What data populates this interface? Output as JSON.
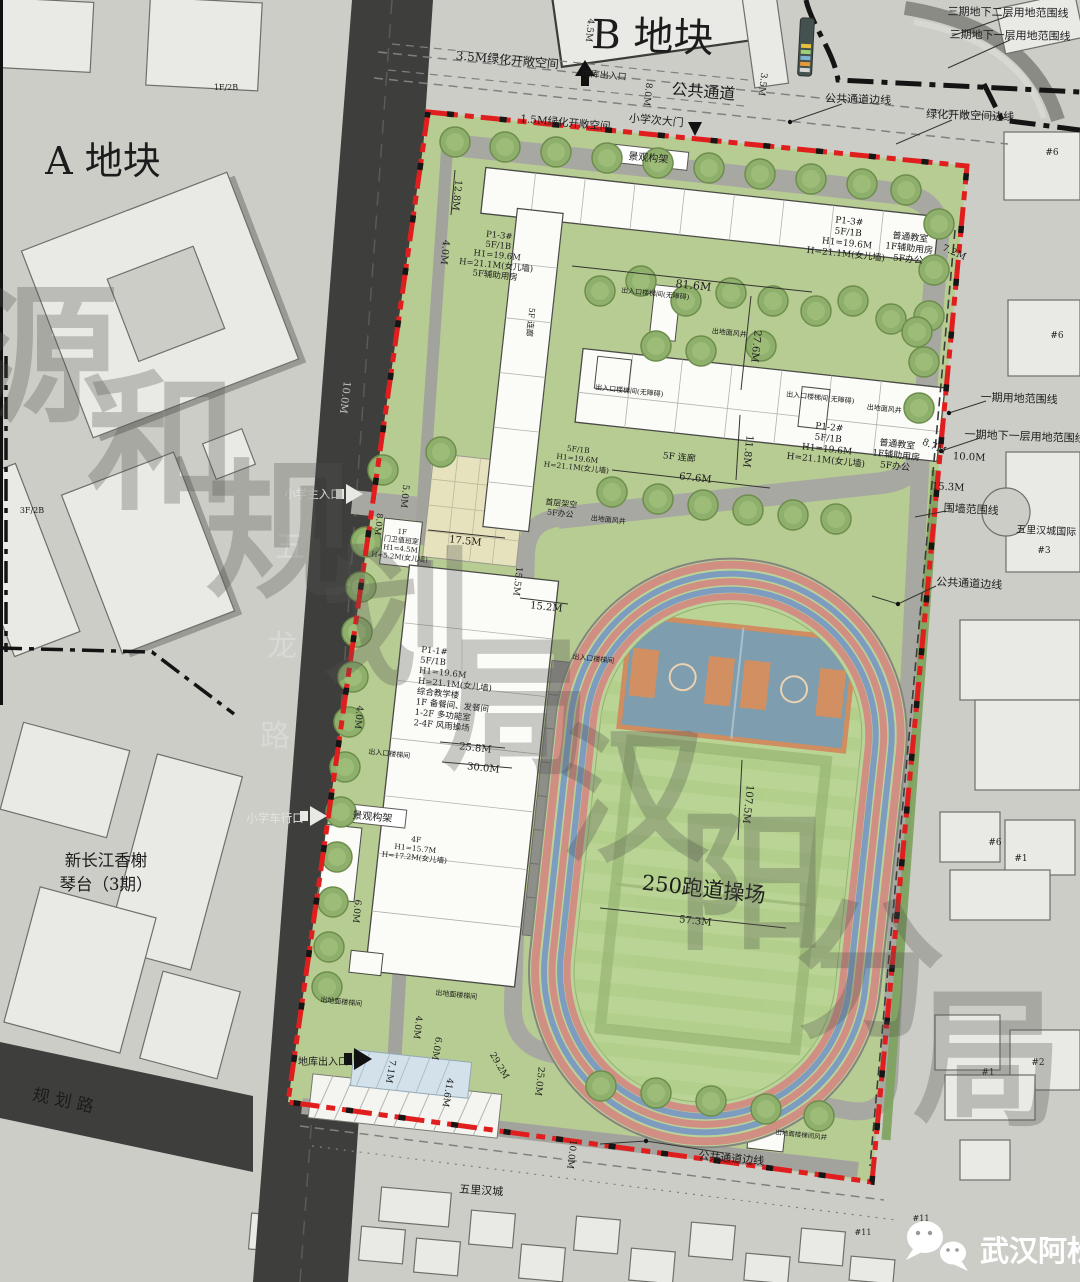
{
  "badge": {
    "text": "武汉阿松"
  },
  "colors": {
    "site_boundary_red": "#e01e1e",
    "phase_boundary_black": "#141414",
    "road_dark": "#3e3e3d",
    "site_green": "#b7cc92",
    "track_red": "#d18f84",
    "track_blue": "#7e9cc0"
  },
  "annotations": [
    {
      "n": "plot-b-label",
      "t": "B 地块",
      "x": 652,
      "y": 50,
      "s": 40,
      "r": 2
    },
    {
      "n": "plot-a-label",
      "t": "A 地块",
      "x": 103,
      "y": 174,
      "s": 38
    },
    {
      "n": "label-phase3-basement2",
      "t": "三期地下二层用地范围线",
      "x": 1008,
      "y": 16,
      "s": 11,
      "r": 1
    },
    {
      "n": "label-phase3-basement1",
      "t": "三期地下一层用地范围线",
      "x": 1010,
      "y": 39,
      "s": 11,
      "r": 1
    },
    {
      "n": "label-green-open-3-5m",
      "t": "3.5M绿化开敞空间",
      "x": 507,
      "y": 64,
      "s": 12,
      "r": 5
    },
    {
      "n": "label-public-passage",
      "t": "公共通道",
      "x": 703,
      "y": 97,
      "s": 16,
      "r": 5
    },
    {
      "n": "label-school-side-gate",
      "t": "小学次大门",
      "x": 656,
      "y": 124,
      "s": 11,
      "r": 5
    },
    {
      "n": "label-b-garage-entry",
      "t": "地库出入口",
      "x": 604,
      "y": 78,
      "s": 9,
      "r": 5
    },
    {
      "n": "label-passage-edge-top",
      "t": "公共通道边线",
      "x": 858,
      "y": 103,
      "s": 11,
      "r": 2
    },
    {
      "n": "label-green-open-edge",
      "t": "绿化开敞空间边线",
      "x": 970,
      "y": 119,
      "s": 11,
      "r": 2
    },
    {
      "n": "label-green-open-1-5m",
      "t": "1.5M绿化开敞空间",
      "x": 565,
      "y": 126,
      "s": 10.5,
      "r": 5
    },
    {
      "n": "label-pergola-top",
      "t": "景观构架",
      "x": 648,
      "y": 161,
      "s": 10,
      "r": 5
    },
    {
      "n": "label-pergola-west",
      "t": "景观构架",
      "x": 372,
      "y": 820,
      "s": 10,
      "r": 5
    },
    {
      "n": "label-main-entrance",
      "t": "小学主入口",
      "x": 313,
      "y": 498,
      "s": 11.5,
      "f": "#e3e3df"
    },
    {
      "n": "label-vehicle-entrance",
      "t": "小学车行口",
      "x": 275,
      "y": 822,
      "s": 11.5,
      "f": "#e3e3df"
    },
    {
      "n": "label-garage-entrance",
      "t": "地库出入口",
      "x": 323,
      "y": 1065,
      "s": 10
    },
    {
      "n": "road-guihua-label",
      "t": "规 划 路",
      "x": 62,
      "y": 1106,
      "s": 17,
      "r": 12
    },
    {
      "n": "road-wulong-char",
      "t": "五",
      "x": 290,
      "y": 557,
      "s": 30,
      "f": "#d8d8d4"
    },
    {
      "n": "road-wulong-char",
      "t": "龙",
      "x": 282,
      "y": 656,
      "s": 30,
      "f": "#d8d8d4"
    },
    {
      "n": "road-wulong-char",
      "t": "路",
      "x": 275,
      "y": 746,
      "s": 30,
      "f": "#d8d8d4"
    },
    {
      "n": "label-xinchangjiang",
      "l": [
        "新长江香榭",
        "琴台（3期）"
      ],
      "x": 106,
      "y": 866,
      "s": 16.5,
      "h": 24
    },
    {
      "n": "building-p1-3-label",
      "l": [
        "P1-3#",
        "5F/1B",
        "H1=19.6M",
        "H=21.1M(女儿墙)"
      ],
      "x": 849,
      "y": 224,
      "s": 9,
      "r": 6,
      "h": 11
    },
    {
      "n": "building-p1-3-use",
      "l": [
        "普通教室",
        "1F辅助用房",
        "5F办公"
      ],
      "x": 910,
      "y": 240,
      "s": 9,
      "r": 6,
      "h": 11
    },
    {
      "n": "building-a-west-label",
      "l": [
        "P1-3#",
        "5F/1B",
        "H1=19.6M",
        "H=21.1M(女儿墙)",
        "5F辅助用房"
      ],
      "x": 499,
      "y": 238,
      "s": 8.5,
      "r": 6,
      "h": 10
    },
    {
      "n": "building-p1-2-label",
      "l": [
        "P1-2#",
        "5F/1B",
        "H1=19.6M",
        "H=21.1M(女儿墙)"
      ],
      "x": 829,
      "y": 430,
      "s": 9,
      "r": 6,
      "h": 11
    },
    {
      "n": "building-p1-2-use",
      "l": [
        "普通教室",
        "1F辅助用房",
        "5F办公"
      ],
      "x": 897,
      "y": 447,
      "s": 9,
      "r": 6,
      "h": 11
    },
    {
      "n": "corridor-b-label",
      "l": [
        "5F/1B",
        "H1=19.6M",
        "H=21.1M(女儿墙)"
      ],
      "x": 578,
      "y": 452,
      "s": 7.5,
      "r": 6,
      "h": 9
    },
    {
      "n": "label-ground-floor-open",
      "l": [
        "首层架空",
        "5F办公"
      ],
      "x": 561,
      "y": 506,
      "s": 8,
      "r": 6,
      "h": 10
    },
    {
      "n": "label-corridor-5f-h",
      "t": "5F 连廊",
      "x": 679,
      "y": 460,
      "s": 9,
      "r": 6
    },
    {
      "n": "label-corridor-5f-v",
      "t": "5F 连廊",
      "x": 528,
      "y": 322,
      "s": 8,
      "r": 96
    },
    {
      "n": "building-p1-1-label",
      "l": [
        "P1-1#",
        "5F/1B",
        "H1=19.6M",
        "H=21.1M(女儿墙)",
        "综合教学楼",
        "1F 备餐间、发餐间",
        "1-2F 多功能室",
        "2-4F 风雨操场"
      ],
      "x": 421,
      "y": 652,
      "s": 8.5,
      "r": 6,
      "h": 10.5,
      "a": "start"
    },
    {
      "n": "guard-house-label",
      "l": [
        "1F",
        "门卫值班室",
        "H1=4.5M",
        "H=5.2M(女儿墙)"
      ],
      "x": 402,
      "y": 534,
      "s": 7,
      "r": 6,
      "h": 8.5
    },
    {
      "n": "building-4f-label",
      "l": [
        "4F",
        "H1=15.7M",
        "H=17.2M(女儿墙)"
      ],
      "x": 416,
      "y": 842,
      "s": 7.5,
      "r": 6,
      "h": 9
    },
    {
      "n": "track-label",
      "t": "250跑道操场",
      "x": 703,
      "y": 896,
      "s": 21,
      "r": 6
    },
    {
      "n": "dim-label",
      "t": "4.5M",
      "x": 587,
      "y": 30,
      "r": 96,
      "s": 9
    },
    {
      "n": "dim-label",
      "t": "8.0M",
      "x": 645,
      "y": 94,
      "r": 97,
      "s": 9
    },
    {
      "n": "dim-label",
      "t": "3.5M",
      "x": 760,
      "y": 84,
      "r": 97,
      "s": 9
    },
    {
      "n": "dim-label",
      "t": "12.8M",
      "x": 454,
      "y": 195,
      "r": 96,
      "s": 9.5
    },
    {
      "n": "dim-label",
      "t": "4.0M",
      "x": 442,
      "y": 252,
      "r": 96,
      "s": 9.5
    },
    {
      "n": "dim-label",
      "t": "81.6M",
      "x": 693,
      "y": 289,
      "r": 6,
      "s": 11
    },
    {
      "n": "dim-label",
      "t": "27.6M",
      "x": 753,
      "y": 346,
      "r": 96,
      "s": 10
    },
    {
      "n": "dim-label",
      "t": "11.8M",
      "x": 745,
      "y": 451,
      "r": 96,
      "s": 10
    },
    {
      "n": "dim-label",
      "t": "67.6M",
      "x": 695,
      "y": 481,
      "r": 6,
      "s": 10
    },
    {
      "n": "dim-label",
      "t": "7.2M",
      "x": 953,
      "y": 255,
      "r": 24,
      "s": 9.5
    },
    {
      "n": "dim-label",
      "t": "8.7M",
      "x": 933,
      "y": 449,
      "r": 24,
      "s": 9.5
    },
    {
      "n": "dim-label",
      "t": "10.0M",
      "x": 969,
      "y": 460,
      "r": 3,
      "s": 10
    },
    {
      "n": "dim-label",
      "t": "15.3M",
      "x": 948,
      "y": 490,
      "r": 3,
      "s": 10
    },
    {
      "n": "dim-label",
      "t": "10.0M",
      "x": 342,
      "y": 397,
      "r": 97,
      "s": 10,
      "f": "#c6c6c2"
    },
    {
      "n": "dim-label",
      "t": "5.0M",
      "x": 402,
      "y": 496,
      "r": 96,
      "s": 9
    },
    {
      "n": "dim-label",
      "t": "8.0M",
      "x": 376,
      "y": 524,
      "r": 96,
      "s": 8.5
    },
    {
      "n": "dim-label",
      "t": "17.5M",
      "x": 465,
      "y": 544,
      "r": 6,
      "s": 10
    },
    {
      "n": "dim-label",
      "t": "15.5M",
      "x": 515,
      "y": 581,
      "r": 96,
      "s": 9
    },
    {
      "n": "dim-label",
      "t": "15.2M",
      "x": 546,
      "y": 610,
      "r": 6,
      "s": 10
    },
    {
      "n": "dim-label",
      "t": "4.0M",
      "x": 356,
      "y": 717,
      "r": 96,
      "s": 9
    },
    {
      "n": "dim-label",
      "t": "25.8M",
      "x": 475,
      "y": 751,
      "r": 6,
      "s": 10
    },
    {
      "n": "dim-label",
      "t": "30.0M",
      "x": 483,
      "y": 771,
      "r": 6,
      "s": 10
    },
    {
      "n": "dim-label",
      "t": "6.0M",
      "x": 354,
      "y": 911,
      "r": 96,
      "s": 9
    },
    {
      "n": "dim-label",
      "t": "4.0M",
      "x": 415,
      "y": 1027,
      "r": 97,
      "s": 9
    },
    {
      "n": "dim-label",
      "t": "6.0M",
      "x": 434,
      "y": 1048,
      "r": 100,
      "s": 9
    },
    {
      "n": "dim-label",
      "t": "7.1M",
      "x": 388,
      "y": 1071,
      "r": 100,
      "s": 9
    },
    {
      "n": "dim-label",
      "t": "41.6M",
      "x": 445,
      "y": 1092,
      "r": 100,
      "s": 9
    },
    {
      "n": "dim-label",
      "t": "29.2M",
      "x": 497,
      "y": 1067,
      "r": 60,
      "s": 9
    },
    {
      "n": "dim-label",
      "t": "25.0M",
      "x": 537,
      "y": 1081,
      "r": 97,
      "s": 9
    },
    {
      "n": "dim-label",
      "t": "57.3M",
      "x": 695,
      "y": 924,
      "r": 6,
      "s": 10
    },
    {
      "n": "dim-label",
      "t": "107.5M",
      "x": 745,
      "y": 804,
      "r": 96,
      "s": 10
    },
    {
      "n": "dim-label",
      "t": "10.0M",
      "x": 569,
      "y": 1154,
      "r": 97,
      "s": 9
    },
    {
      "n": "utility-label",
      "t": "出入口楼梯间(无障碍)",
      "x": 655,
      "y": 296,
      "s": 7,
      "r": 6
    },
    {
      "n": "utility-label",
      "t": "出入口楼梯间(无障碍)",
      "x": 629,
      "y": 393,
      "s": 7,
      "r": 6
    },
    {
      "n": "utility-label",
      "t": "出入口楼梯间(无障碍)",
      "x": 820,
      "y": 400,
      "s": 7,
      "r": 6
    },
    {
      "n": "utility-label",
      "t": "出地面风井",
      "x": 729,
      "y": 335,
      "s": 7,
      "r": 6
    },
    {
      "n": "utility-label",
      "t": "出地面风井",
      "x": 884,
      "y": 411,
      "s": 7,
      "r": 6
    },
    {
      "n": "utility-label",
      "t": "出地面风井",
      "x": 608,
      "y": 522,
      "s": 7,
      "r": 6
    },
    {
      "n": "utility-label",
      "t": "出入口楼梯间",
      "x": 593,
      "y": 661,
      "s": 7,
      "r": 6
    },
    {
      "n": "utility-label",
      "t": "出入口楼梯间",
      "x": 389,
      "y": 756,
      "s": 7,
      "r": 6
    },
    {
      "n": "utility-label",
      "t": "出地面楼梯间",
      "x": 341,
      "y": 1004,
      "s": 7,
      "r": 6
    },
    {
      "n": "utility-label",
      "t": "出地面楼梯间",
      "x": 456,
      "y": 997,
      "s": 7,
      "r": 6
    },
    {
      "n": "utility-label",
      "t": "出地面楼梯间风井",
      "x": 801,
      "y": 1137,
      "s": 6.5,
      "r": 6
    },
    {
      "n": "label-phase1-boundary",
      "t": "一期用地范围线",
      "x": 1019,
      "y": 402,
      "s": 11,
      "r": 2
    },
    {
      "n": "label-phase1-basement1",
      "t": "一期地下一层用地范围线",
      "x": 1025,
      "y": 440,
      "s": 11,
      "r": 2
    },
    {
      "n": "label-wall-boundary",
      "t": "围墙范围线",
      "x": 971,
      "y": 513,
      "s": 11,
      "r": 3
    },
    {
      "n": "label-wulihancheng-intl",
      "t": "五里汉城国际",
      "x": 1046,
      "y": 534,
      "s": 10,
      "r": 3
    },
    {
      "n": "bldg-no",
      "t": "#3",
      "x": 1044,
      "y": 553,
      "s": 9
    },
    {
      "n": "label-passage-edge-right",
      "t": "公共通道边线",
      "x": 969,
      "y": 587,
      "s": 11,
      "r": 3
    },
    {
      "n": "label-passage-edge-bottom",
      "t": "公共通道边线",
      "x": 731,
      "y": 1162,
      "s": 11,
      "r": 5
    },
    {
      "n": "label-wulihancheng",
      "t": "五里汉城",
      "x": 481,
      "y": 1194,
      "s": 11,
      "r": 4
    },
    {
      "n": "bldg-no",
      "t": "#6",
      "x": 1052,
      "y": 155,
      "s": 9
    },
    {
      "n": "bldg-no",
      "t": "#6",
      "x": 1057,
      "y": 338,
      "s": 9
    },
    {
      "n": "bldg-no",
      "t": "#6",
      "x": 995,
      "y": 845,
      "s": 9
    },
    {
      "n": "bldg-no",
      "t": "#1",
      "x": 1021,
      "y": 861,
      "s": 9
    },
    {
      "n": "bldg-no",
      "t": "#2",
      "x": 1038,
      "y": 1065,
      "s": 9
    },
    {
      "n": "bldg-no",
      "t": "#1",
      "x": 988,
      "y": 1075,
      "s": 9
    },
    {
      "n": "bldg-no",
      "t": "#11",
      "x": 921,
      "y": 1221,
      "s": 8
    },
    {
      "n": "bldg-no",
      "t": "#11",
      "x": 863,
      "y": 1235,
      "s": 8
    },
    {
      "n": "bldg-no",
      "t": "1F/2B",
      "x": 226,
      "y": 90,
      "s": 8
    },
    {
      "n": "bldg-no",
      "t": "3F/2B",
      "x": 32,
      "y": 513,
      "s": 8
    },
    {
      "n": "watermark-char",
      "t": "源",
      "x": 44,
      "y": 408,
      "s": 150,
      "f": "rgba(84,84,80,0.3)",
      "w": "bold",
      "sf": true
    },
    {
      "n": "watermark-char",
      "t": "和",
      "x": 162,
      "y": 496,
      "s": 150,
      "f": "rgba(84,84,80,0.3)",
      "w": "bold",
      "sf": true
    },
    {
      "n": "watermark-char",
      "t": "规",
      "x": 280,
      "y": 584,
      "s": 150,
      "f": "rgba(84,84,80,0.3)",
      "w": "bold",
      "sf": true
    },
    {
      "n": "watermark-char",
      "t": "划",
      "x": 398,
      "y": 672,
      "s": 150,
      "f": "rgba(84,84,80,0.3)",
      "w": "bold",
      "sf": true
    },
    {
      "n": "watermark-char",
      "t": "局",
      "x": 516,
      "y": 760,
      "s": 150,
      "f": "rgba(84,84,80,0.3)",
      "w": "bold",
      "sf": true
    },
    {
      "n": "watermark-char",
      "t": "汉",
      "x": 634,
      "y": 848,
      "s": 150,
      "f": "rgba(84,84,80,0.3)",
      "w": "bold",
      "sf": true
    },
    {
      "n": "watermark-char",
      "t": "阳",
      "x": 752,
      "y": 936,
      "s": 150,
      "f": "rgba(84,84,80,0.3)",
      "w": "bold",
      "sf": true
    },
    {
      "n": "watermark-char",
      "t": "分",
      "x": 870,
      "y": 1024,
      "s": 150,
      "f": "rgba(84,84,80,0.3)",
      "w": "bold",
      "sf": true
    },
    {
      "n": "watermark-char",
      "t": "局",
      "x": 988,
      "y": 1112,
      "s": 150,
      "f": "rgba(84,84,80,0.3)",
      "w": "bold",
      "sf": true
    }
  ]
}
